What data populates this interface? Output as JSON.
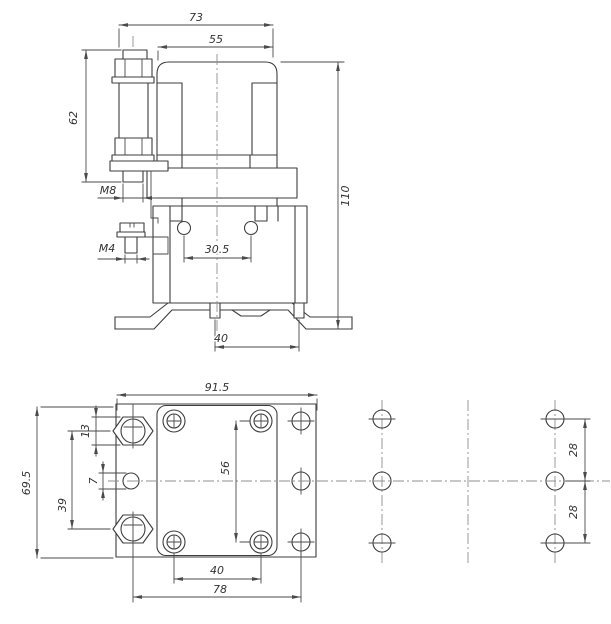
{
  "drawing_colors": {
    "background": "#ffffff",
    "part_line": "#3d3d3d",
    "dimension_line": "#4a4a4a",
    "centerline": "#8f8f8f",
    "text": "#333333"
  },
  "top_view": {
    "id": "side-elevation",
    "dims": {
      "overall_width": "73",
      "housing_width": "55",
      "terminal_height": "62",
      "terminal_thread": "M8",
      "aux_thread": "M4",
      "hole_spacing": "30.5",
      "overall_height": "110",
      "pin_spacing": "40"
    }
  },
  "bottom_view": {
    "id": "bottom-plan",
    "dims": {
      "plate_width": "91.5",
      "plate_depth": "69.5",
      "hex_flats": "13",
      "terminal_pitch": "39",
      "aux_hole_dia": "7",
      "screw_pitch_vertical": "56",
      "screw_pitch_horizontal": "40",
      "mounting_pitch": "78",
      "drill_pitch_upper": "28",
      "drill_pitch_lower": "28"
    }
  }
}
